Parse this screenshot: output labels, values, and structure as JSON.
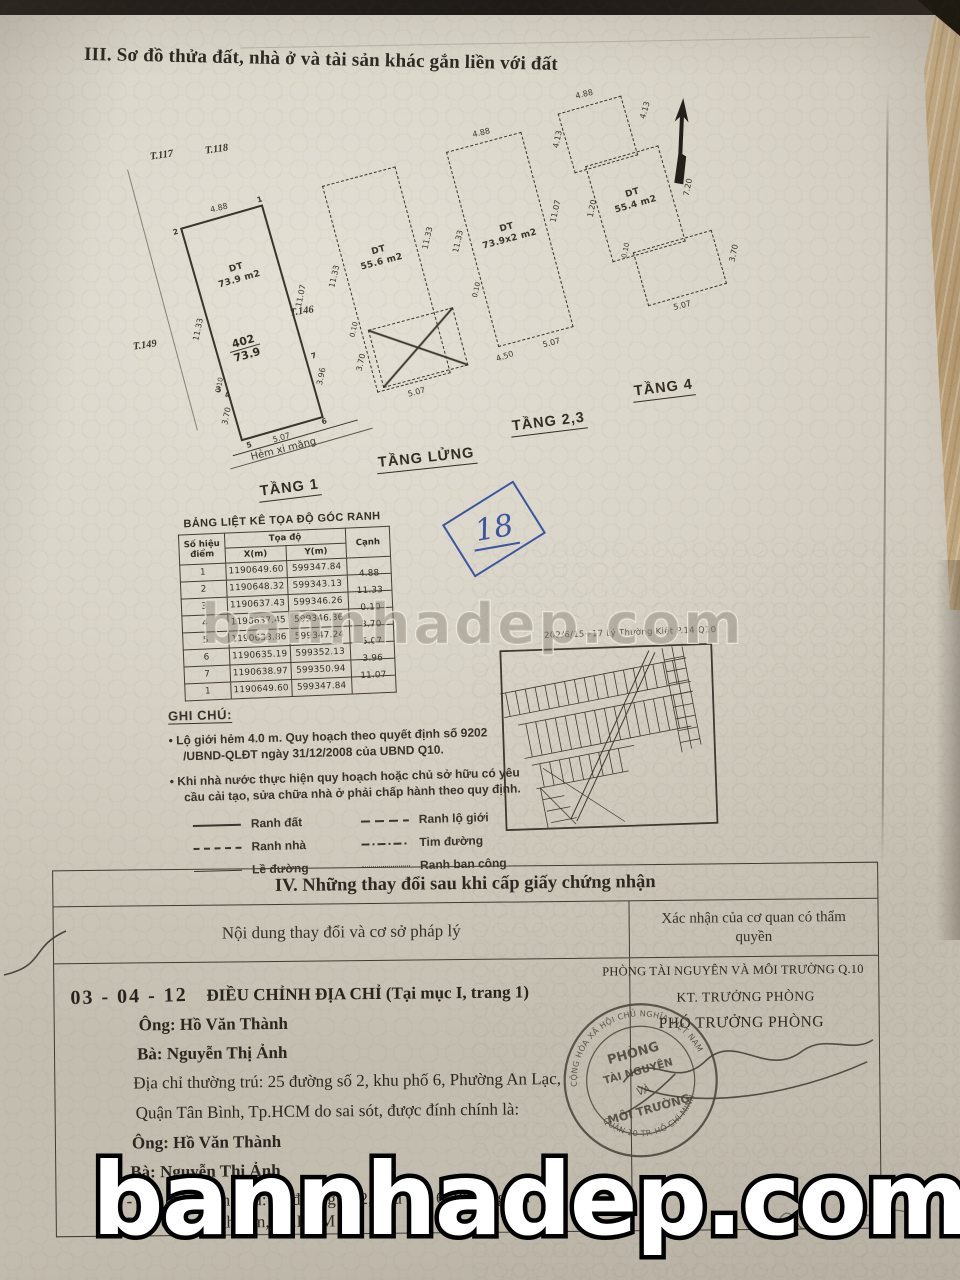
{
  "watermark": {
    "text": "bannhadep.com"
  },
  "plot_section": {
    "title": "III. Sơ đồ thửa đất, nhà ở và tài sản khác gắn liền với đất",
    "handwritten_number": "18",
    "map_label": "202/6/15+17 Lý Thường Kiệt P.14 Q10",
    "street_label": "Hẻm xi măng",
    "survey_marks": {
      "m1": "T.117",
      "m2": "T.118",
      "m3": "T.149",
      "m4": "T.146"
    },
    "plans": [
      {
        "label": "TẦNG 1",
        "dt": "DT",
        "area": "73.9 m2",
        "lot": "402",
        "lot_area": "73.9",
        "dims": {
          "top": "4.88",
          "left": "11.33",
          "right": "11.07",
          "right2": "3.96",
          "bottom": "5.07",
          "s1": "0.10",
          "s2": "3.70"
        },
        "corners": {
          "c1": "1",
          "c2": "2",
          "c3": "3",
          "c4": "4",
          "c5": "5",
          "c6": "6",
          "c7": "7"
        }
      },
      {
        "label": "TẦNG LỬNG",
        "dt": "DT",
        "area": "55.6 m2",
        "dims": {
          "left": "11.33",
          "right": "11.33",
          "bottom": "5.07",
          "s1": "0.10",
          "s2": "3.70"
        }
      },
      {
        "label": "TẦNG 2,3",
        "dt": "DT",
        "area": "73.9x2 m2",
        "dims": {
          "top": "4.88",
          "left": "11.33",
          "right": "11.07",
          "bottom": "5.07",
          "s1": "0.10",
          "s2": "4.50"
        }
      },
      {
        "label": "TẦNG 4",
        "dt": "DT",
        "area": "55.4 m2",
        "dims": {
          "top": "4.88",
          "tr": "4.13",
          "left": "4.13",
          "right": "7.20",
          "mid": "1.20",
          "br": "3.70",
          "bottom": "5.07",
          "s1": "0.10"
        }
      }
    ]
  },
  "coord_table": {
    "title": "BẢNG LIỆT KÊ TỌA ĐỘ GÓC RANH",
    "col_point": "Số hiệu điểm",
    "col_coord": "Tọa độ",
    "col_x": "X(m)",
    "col_y": "Y(m)",
    "col_edge": "Cạnh",
    "rows": [
      {
        "p": "1",
        "x": "1190649.60",
        "y": "599347.84"
      },
      {
        "p": "2",
        "x": "1190648.32",
        "y": "599343.13"
      },
      {
        "p": "3",
        "x": "1190637.43",
        "y": "599346.26"
      },
      {
        "p": "4",
        "x": "1190637.45",
        "y": "599346.36"
      },
      {
        "p": "5",
        "x": "1190633.86",
        "y": "599347.24"
      },
      {
        "p": "6",
        "x": "1190635.19",
        "y": "599352.13"
      },
      {
        "p": "7",
        "x": "1190638.97",
        "y": "599350.94"
      },
      {
        "p": "1",
        "x": "1190649.60",
        "y": "599347.84"
      }
    ],
    "edges": [
      "4.88",
      "11.33",
      "0.10",
      "3.70",
      "5.07",
      "3.96",
      "11.07"
    ]
  },
  "notes": {
    "heading": "GHI CHÚ:",
    "bullet1": "• Lộ giới hẻm 4.0 m. Quy hoạch theo quyết định số 9202 /UBND-QLĐT ngày 31/12/2008 của UBND Q10.",
    "bullet2": "• Khi nhà nước thực hiện quy hoạch hoặc chủ sở hữu có yêu cầu cải tạo, sửa chữa nhà ở phải chấp hành theo quy định.",
    "legend": [
      {
        "label": "Ranh đất"
      },
      {
        "label": "Ranh lộ giới"
      },
      {
        "label": "Ranh nhà"
      },
      {
        "label": "Tim đường"
      },
      {
        "label": "Lề đường"
      },
      {
        "label": "Ranh ban công"
      }
    ]
  },
  "section4": {
    "title": "IV. Những thay đổi sau khi cấp giấy chứng nhận",
    "col_left": "Nội dung thay đổi và cơ sở pháp lý",
    "col_right": "Xác nhận của cơ quan có thẩm quyền",
    "entry": {
      "date": "03 - 04 - 12",
      "heading": "ĐIỀU CHỈNH ĐỊA CHỈ (Tại mục I, trang 1)",
      "lines": [
        "Ông: Hồ Văn Thành",
        "Bà: Nguyễn Thị Ảnh",
        "Địa chỉ thường trú: 25 đường số 2, khu phố 6, Phường An Lạc,",
        "Quận Tân Bình, Tp.HCM do sai sót, được đính chính là:",
        "Ông: Hồ Văn Thành",
        "Bà: Nguyễn Thị Ảnh",
        "- Địa chỉ thường trú: 25 đường số 2, khu phố 6, Phường An",
        "Lạc, Quận Bình Tân, Tp.HCM"
      ]
    },
    "authority": {
      "office": "PHÒNG TÀI NGUYÊN VÀ MÔI TRƯỜNG Q.10",
      "title1": "KT. TRƯỞNG PHÒNG",
      "title2": "PHÓ TRƯỞNG PHÒNG",
      "stamp": {
        "top_arc": "CỘNG HÒA XÃ HỘI CHỦ NGHĨA VIỆT NAM",
        "line1": "PHÒNG",
        "line2": "TÀI NGUYÊN",
        "line3": "VÀ",
        "line4": "MÔI TRƯỜNG",
        "bottom_arc": "QUẬN 10 TP. HỒ CHÍ MINH"
      }
    }
  }
}
